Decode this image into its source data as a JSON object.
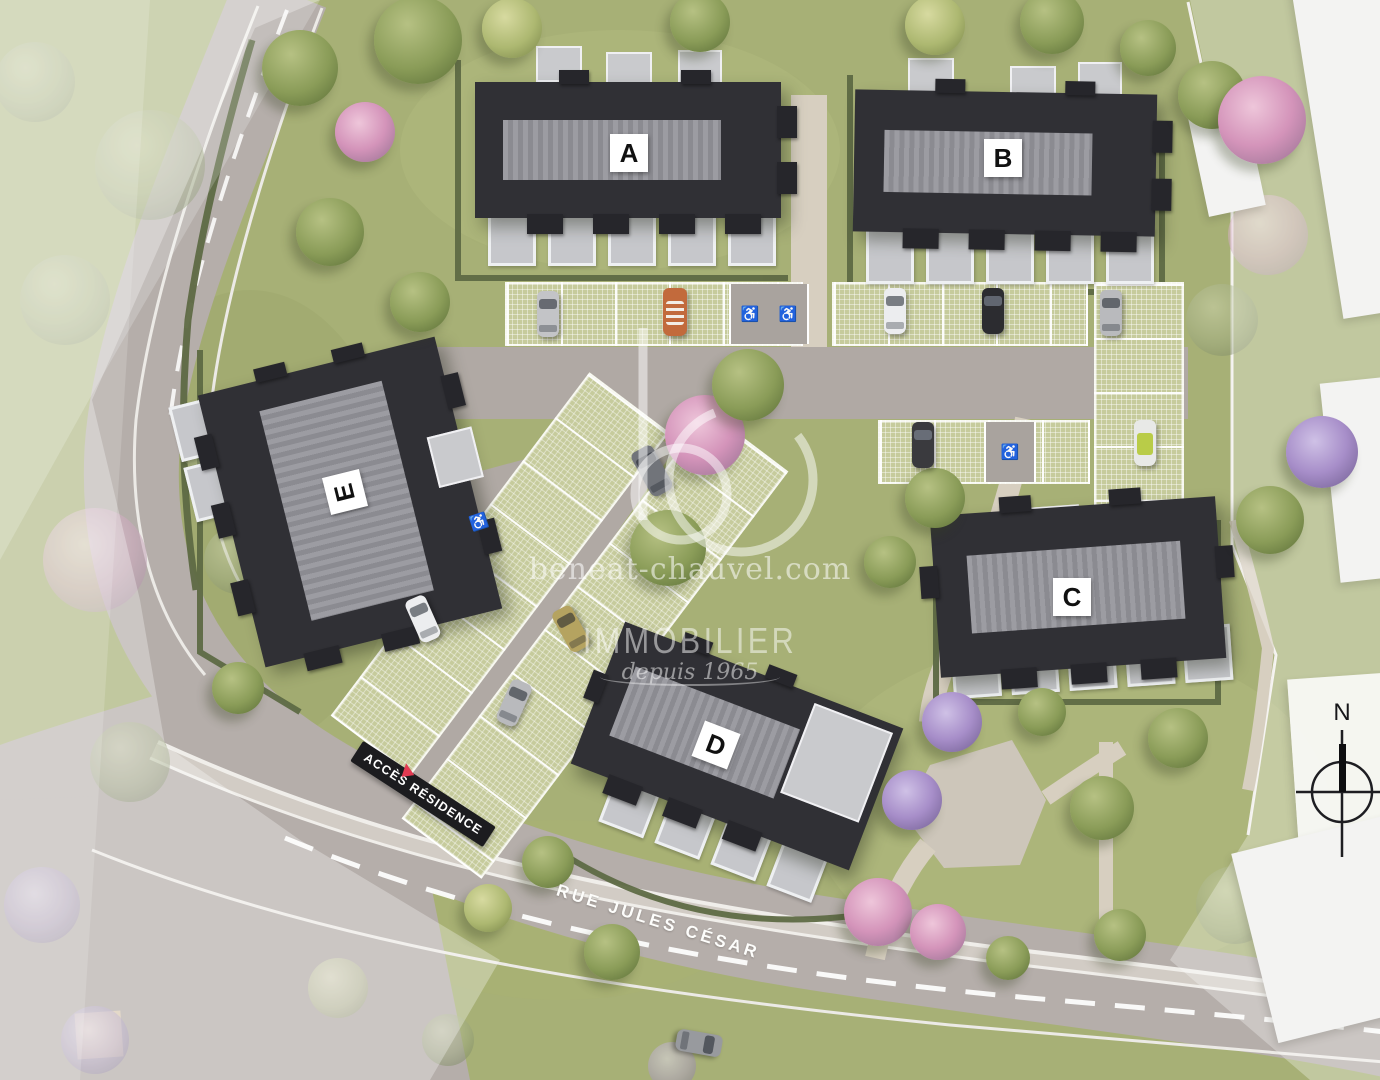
{
  "buildings": [
    {
      "id": "a",
      "label": "A"
    },
    {
      "id": "b",
      "label": "B"
    },
    {
      "id": "c",
      "label": "C"
    },
    {
      "id": "d",
      "label": "D"
    },
    {
      "id": "e",
      "label": "E"
    }
  ],
  "watermark": {
    "logo": "bc",
    "website": "beneat-chauvel.com",
    "brand": "IMMOBILIER",
    "tagline": "depuis 1965"
  },
  "signs": {
    "access": "ACCÈS RÉSIDENCE",
    "street": "RUE JULES CÉSAR"
  },
  "compass": {
    "north": "N"
  },
  "icons": {
    "wheelchair-icon": "♿",
    "access-triangle-icon": "▲"
  },
  "colors": {
    "roof_dark": "#303035",
    "roof_ridge": "#95959b",
    "grass": "#a7b076",
    "paver_parking": "#c6cb9c",
    "road": "#b5aeaa",
    "footpath": "#d7cfc0",
    "hedge": "#5e6a44",
    "accent_red": "#e23a52",
    "label_bg": "#ffffff",
    "label_text": "#111111",
    "watermark": "rgba(255,255,255,0.55)"
  }
}
